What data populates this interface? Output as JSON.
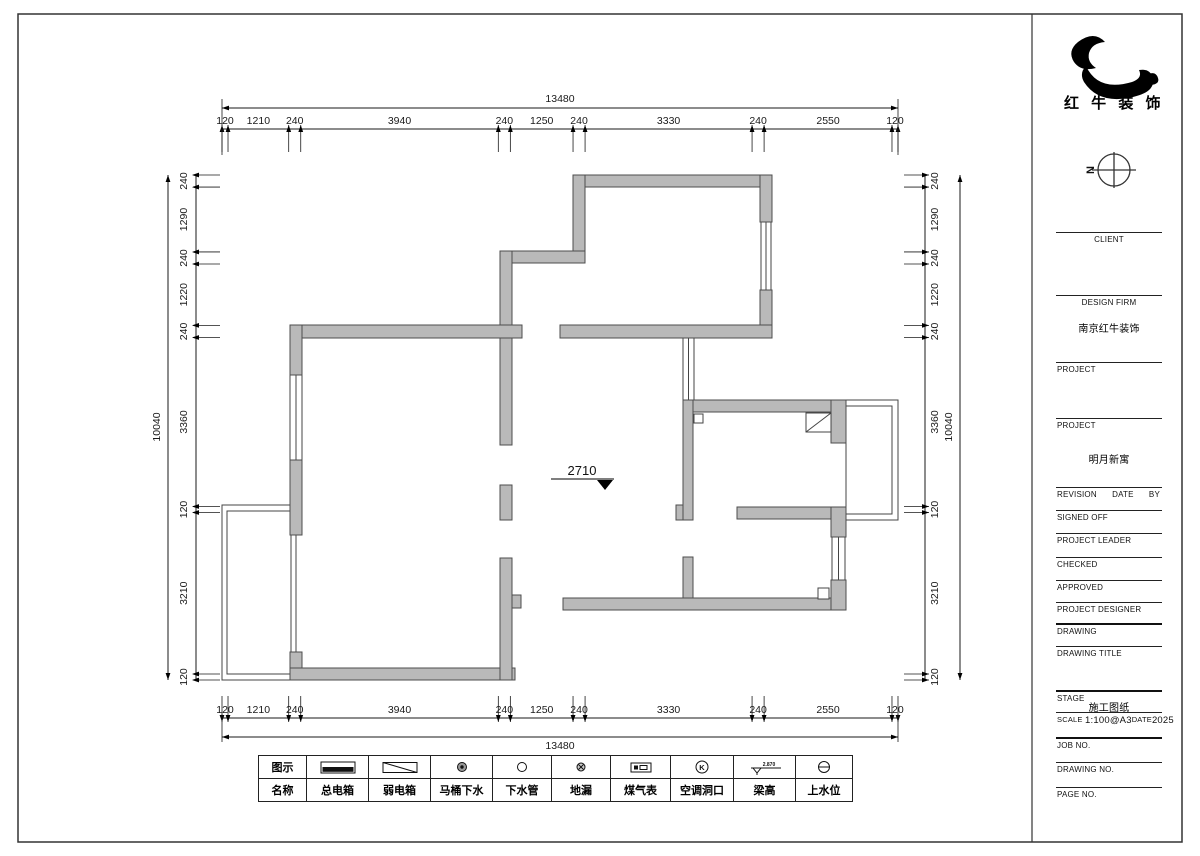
{
  "logo": {
    "brand": "红 牛 装 饰"
  },
  "north": {
    "label": "N"
  },
  "drawing": {
    "level_mark": "2710"
  },
  "dimensions": {
    "top": {
      "total": "13480",
      "segments": [
        "120",
        "1210",
        "240",
        "3940",
        "240",
        "1250",
        "240",
        "3330",
        "240",
        "2550",
        "120"
      ]
    },
    "bottom": {
      "total": "13480",
      "segments": [
        "120",
        "1210",
        "240",
        "3940",
        "240",
        "1250",
        "240",
        "3330",
        "240",
        "2550",
        "120"
      ]
    },
    "left": {
      "total": "10040",
      "segments": [
        "240",
        "1290",
        "240",
        "1220",
        "240",
        "3360",
        "120",
        "3210",
        "120"
      ]
    },
    "right": {
      "total": "10040",
      "segments": [
        "240",
        "1290",
        "240",
        "1220",
        "240",
        "3360",
        "120",
        "3210",
        "120"
      ]
    }
  },
  "title_block": {
    "rows": [
      {
        "id": "client",
        "label": "CLIENT",
        "align": "center"
      },
      {
        "id": "design-firm",
        "label": "DESIGN FIRM",
        "align": "center",
        "value": "南京红牛装饰"
      },
      {
        "id": "project-1",
        "label": "PROJECT"
      },
      {
        "id": "project-2",
        "label": "PROJECT",
        "value": "明月新寓"
      },
      {
        "id": "revision",
        "labels": [
          "REVISION",
          "DATE",
          "BY"
        ]
      },
      {
        "id": "signed-off",
        "label": "SIGNED OFF"
      },
      {
        "id": "project-leader",
        "label": "PROJECT LEADER"
      },
      {
        "id": "checked",
        "label": "CHECKED"
      },
      {
        "id": "approved",
        "label": "APPROVED"
      },
      {
        "id": "project-designer",
        "label": "PROJECT DESIGNER"
      },
      {
        "id": "drawing",
        "label": "DRAWING"
      },
      {
        "id": "drawing-title",
        "label": "DRAWING TITLE"
      },
      {
        "id": "stage",
        "label": "STAGE",
        "value": "施工图纸"
      },
      {
        "id": "scale",
        "label": "SCALE",
        "value": "1:100@A3",
        "label2": "DATE",
        "value2": "2025"
      },
      {
        "id": "job-no",
        "label": "JOB NO."
      },
      {
        "id": "drawing-no",
        "label": "DRAWING NO."
      },
      {
        "id": "page-no",
        "label": "PAGE NO."
      }
    ]
  },
  "legend": {
    "header_icon_row": "图示",
    "header_name_row": "名称",
    "items": [
      {
        "icon": "main-electric-box-icon",
        "label": "总电箱"
      },
      {
        "icon": "weak-electric-box-icon",
        "label": "弱电箱"
      },
      {
        "icon": "toilet-drain-icon",
        "label": "马桶下水"
      },
      {
        "icon": "drain-pipe-icon",
        "label": "下水管"
      },
      {
        "icon": "floor-drain-icon",
        "label": "地漏"
      },
      {
        "icon": "gas-meter-icon",
        "label": "煤气表"
      },
      {
        "icon": "ac-opening-icon",
        "label": "空调洞口",
        "letter": "K"
      },
      {
        "icon": "beam-height-icon",
        "label": "梁高",
        "beam_value": "2.870"
      },
      {
        "icon": "water-supply-icon",
        "label": "上水位"
      }
    ]
  },
  "colors": {
    "wall_fill": "#b9b9b9",
    "wall_stroke": "#4d4d4d",
    "line": "#1a1a1a"
  }
}
